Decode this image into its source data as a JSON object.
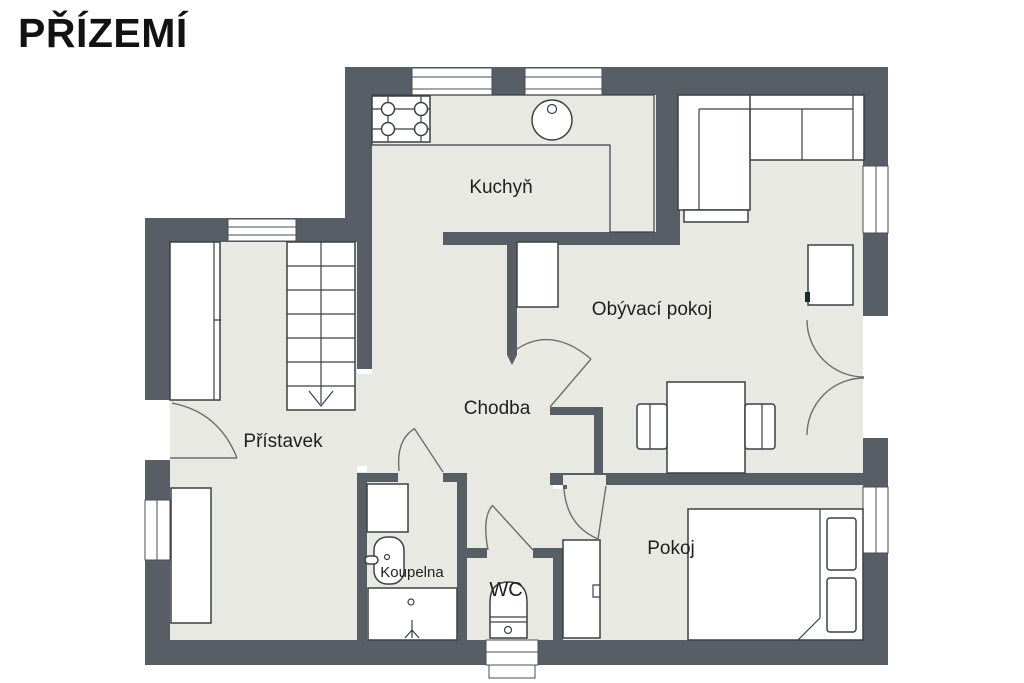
{
  "header": {
    "title": "PŘÍZEMÍ"
  },
  "palette": {
    "background": "#FFFFFF",
    "wall": "#575E66",
    "floor": "#E9E9E3",
    "line": "#3C4043",
    "arc": "#6E6E6E",
    "title_color": "#121212",
    "label_color": "#1F1F1F"
  },
  "rooms": {
    "kuchyn": {
      "label": "Kuchyň"
    },
    "obyvaci_pokoj": {
      "label": "Obývací pokoj"
    },
    "chodba": {
      "label": "Chodba"
    },
    "pristavek": {
      "label": "Přístavek"
    },
    "koupelna": {
      "label": "Koupelna"
    },
    "wc": {
      "label": "WC"
    },
    "pokoj": {
      "label": "Pokoj"
    }
  }
}
